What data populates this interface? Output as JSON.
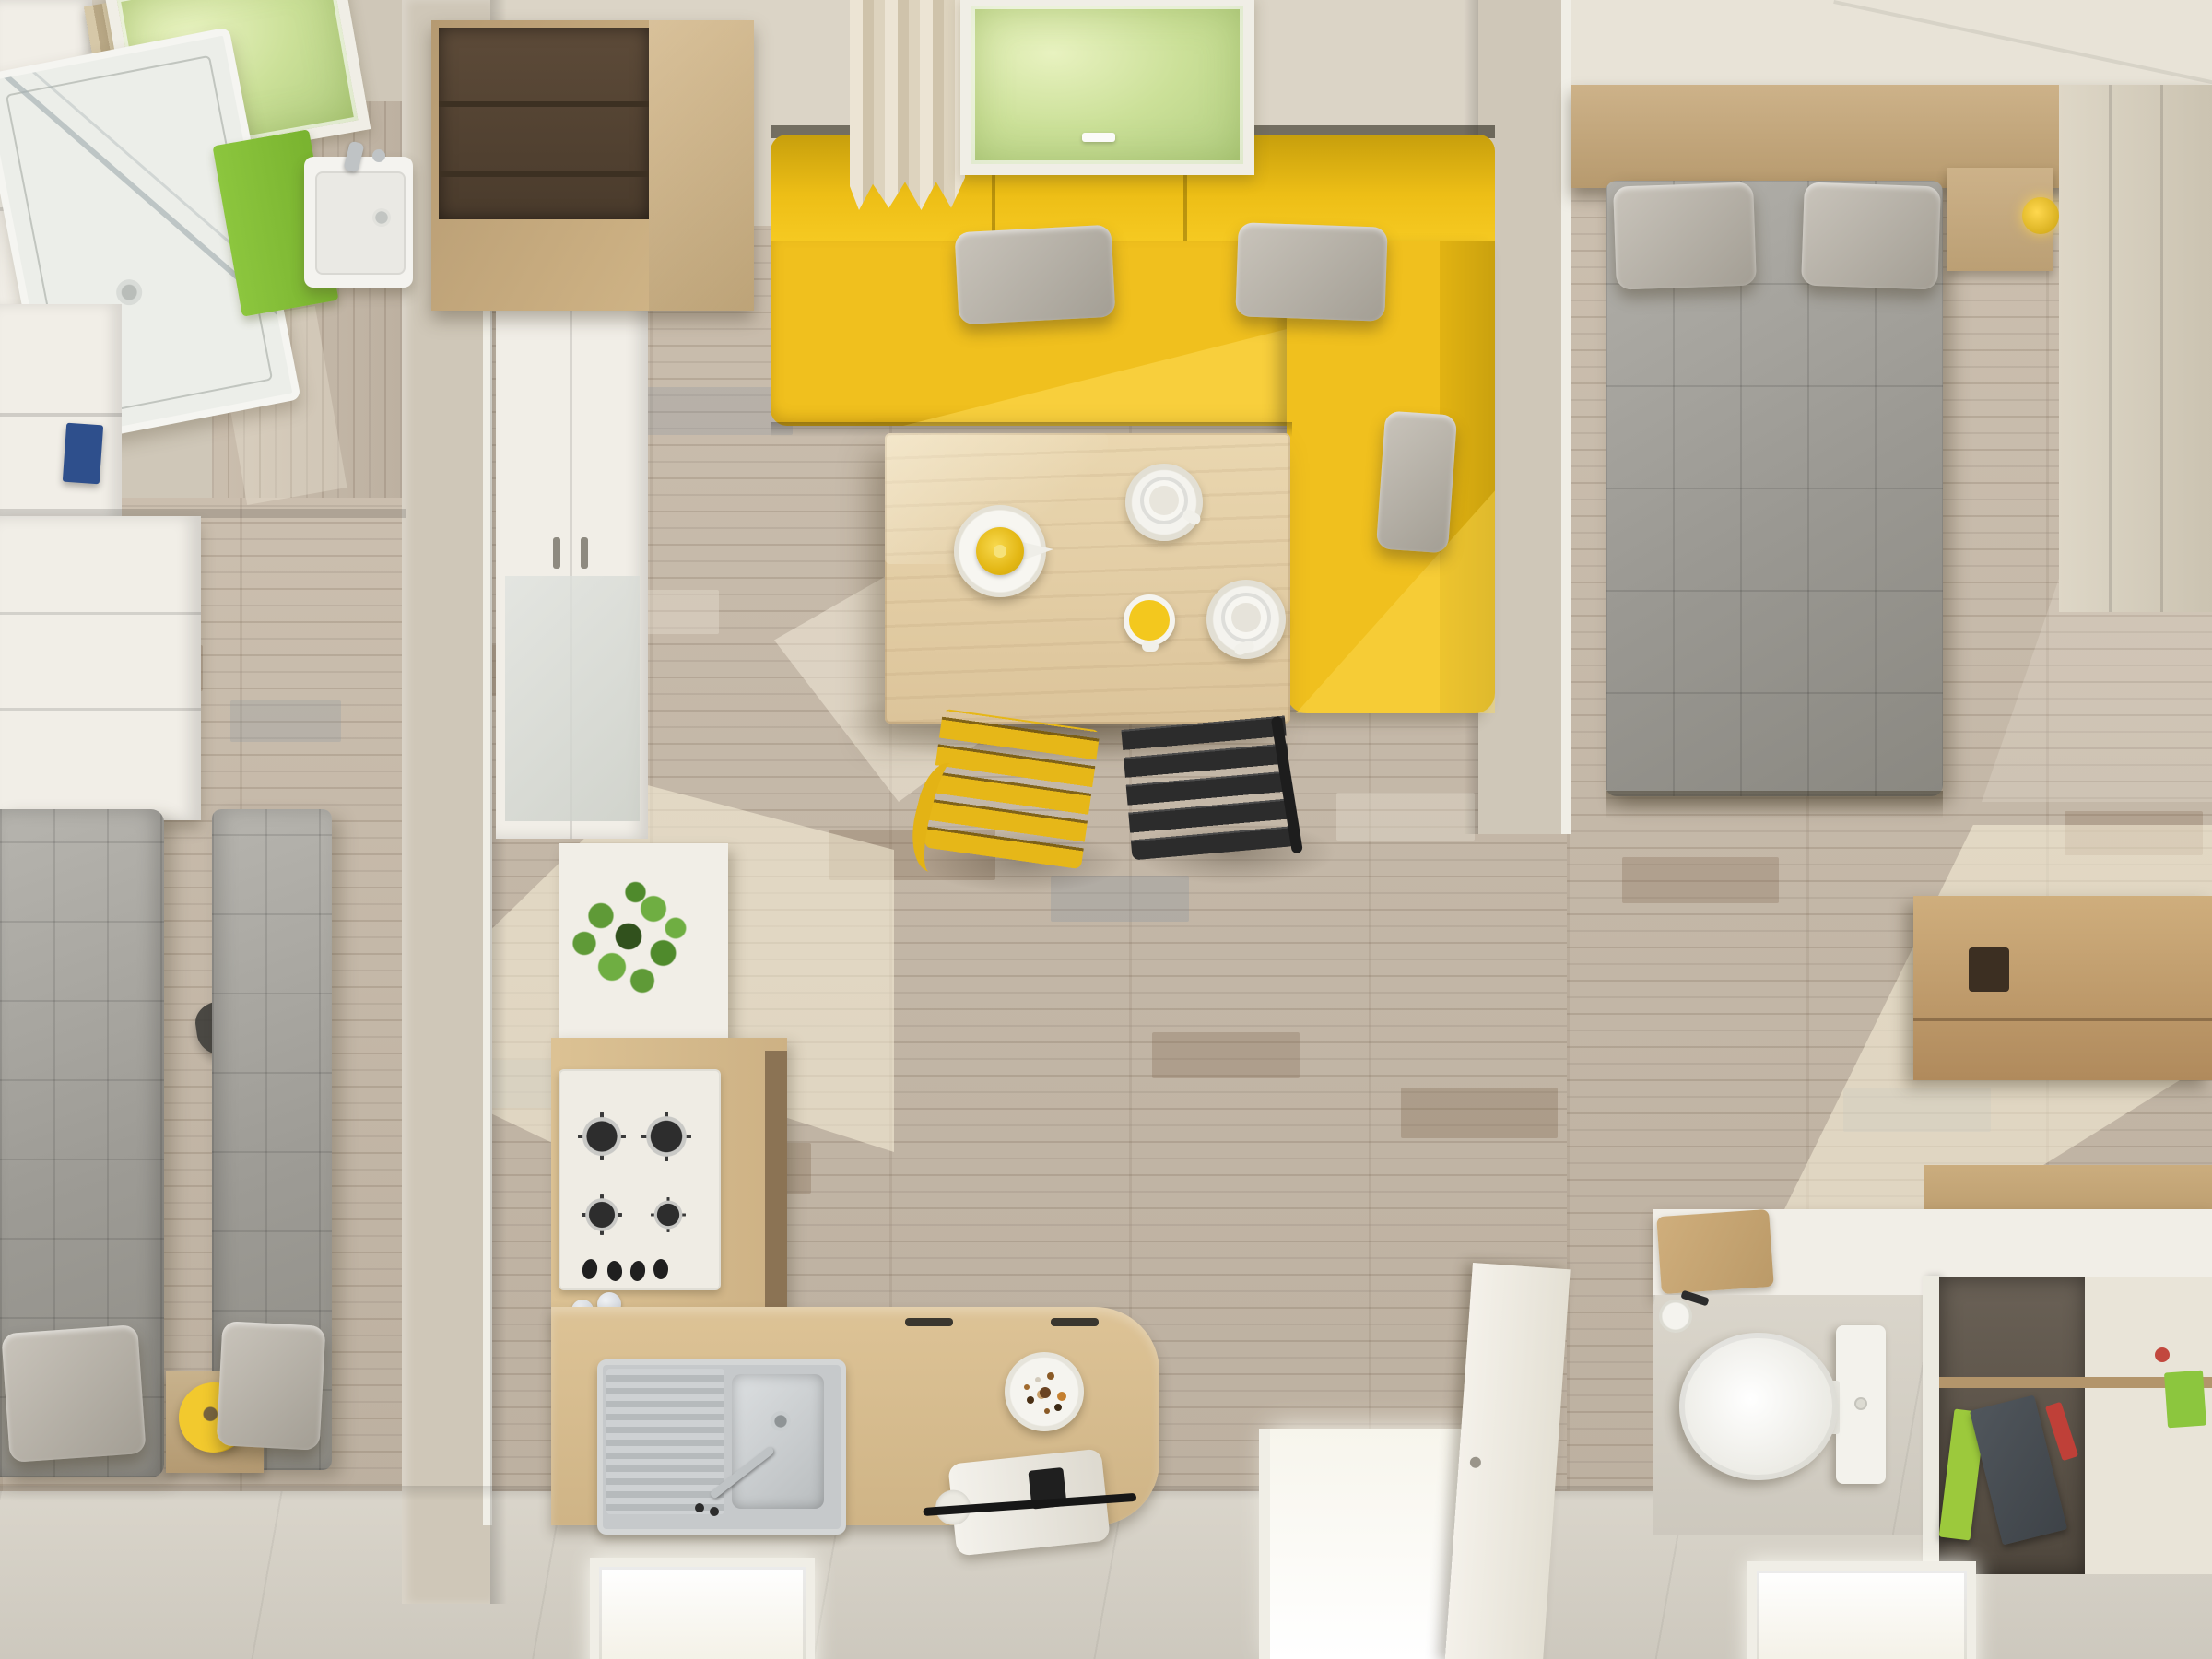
{
  "scene": {
    "type": "natural-image",
    "subject": "Photorealistic top-down 3D render of a compact apartment / mobile-home interior",
    "view": "overhead floor-plan style camera, no visible text anywhere in the image",
    "lighting": "daylight through skylights and floor-level windows, warm sun patches on weathered plank flooring",
    "rooms": [
      {
        "name": "bathroom-top-left",
        "objects": [
          "angled skylight with greenery view",
          "pleated roller blind",
          "walk-in shower with glass screen and drain",
          "lime-green bath mat",
          "white washbasin with chrome faucet",
          "white wall cabinets",
          "blue storage box on shelf",
          "pale plank floor"
        ]
      },
      {
        "name": "left-bedroom",
        "objects": [
          "white wardrobe and shelving along wall",
          "two single beds with grey quilted covers",
          "two grey pillows at foot end",
          "wooden nightstand between beds",
          "yellow ring cushion",
          "dark stool"
        ]
      },
      {
        "name": "living-room-center",
        "objects": [
          "tall wooden cabinet with dark open shelf",
          "cream pleated curtain",
          "skylight with greenery view",
          "yellow L-shaped corner sofa",
          "three grey cushions on sofa",
          "light-wood dining table",
          "yellow teapot",
          "two white cups with saucers",
          "yellow mug",
          "yellow slatted chair",
          "black slatted chair",
          "sunlit weathered plank floor"
        ]
      },
      {
        "name": "kitchen-bottom-center",
        "objects": [
          "white tall cabinet bank",
          "white counter with green potted plant",
          "white gas hob with four burners and four knobs",
          "garlic bulbs on counter",
          "L-shaped wooden counter with curved end",
          "stainless-steel sink with drainboard and faucet",
          "two dark drawer handles",
          "plate of snacks",
          "white coffee machine with black handle",
          "floor-level window"
        ]
      },
      {
        "name": "right-bedroom",
        "objects": [
          "white ceiling band",
          "wooden headboard shelf",
          "double bed with grey quilted duvet",
          "two grey pillows",
          "wooden nightstand with small yellow lamp",
          "beige wardrobe on right wall",
          "wooden storage chest",
          "large sun patch on floor"
        ]
      },
      {
        "name": "bathroom-bottom-right",
        "objects": [
          "white desk counter",
          "wooden cutting boards",
          "under-desk drawers with black hook handles",
          "white toilet with cistern",
          "toilet-paper holder",
          "white partition wall",
          "open shelf with lime-green book, grey folder and red object",
          "floor-level window"
        ]
      },
      {
        "name": "openings",
        "objects": [
          "entry doorway glowing with light",
          "open white door leaf",
          "floor-level windows along the bottom wall"
        ]
      }
    ]
  },
  "palette": {
    "ceiling": "#dbd4c6",
    "wall": "#cfc7b8",
    "wall-light": "#e8e3d7",
    "frame-white": "#f0eee6",
    "floor-base": "#c8bbaa",
    "tile": "#d8d3c8",
    "white-cab": "#f1eee7",
    "wood-cab": "#c3a77c",
    "wood-dark": "#5d4b39",
    "bed-gray": "#9c9c9a",
    "bed-light": "#b8b6b0",
    "pillow-gray": "#b5b0a6",
    "sofa-yellow": "#f0c01e",
    "sofa-deep": "#c79f0c",
    "sofa-light": "#ffd84e",
    "table-wood": "#e2cda6",
    "chair-yellow": "#e6b718",
    "chair-black": "#2c2c2c",
    "plant-green": "#5f9a37",
    "mat-green": "#8cc63e",
    "chrome": "#bfc3c5",
    "sun": "rgba(255,247,224,0.5)"
  }
}
